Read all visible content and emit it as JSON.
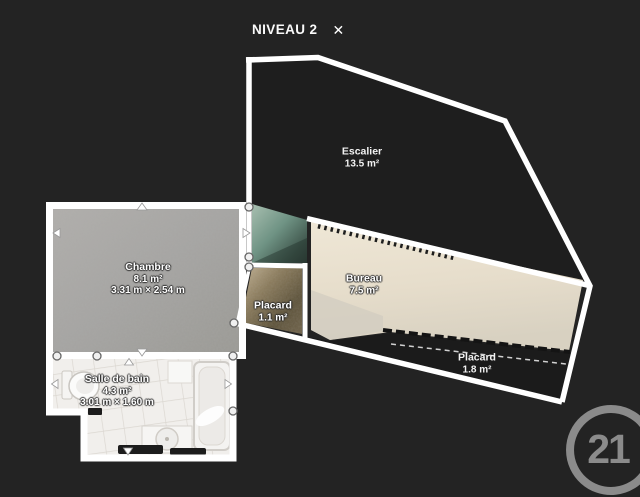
{
  "header": {
    "title": "NIVEAU 2",
    "close_label": "✕"
  },
  "rooms": [
    {
      "key": "escalier",
      "name": "Escalier",
      "area": "13.5 m²"
    },
    {
      "key": "chambre",
      "name": "Chambre",
      "area": "8.1 m²",
      "dims": "3.31 m × 2.54 m"
    },
    {
      "key": "placard-centre",
      "name": "Placard",
      "area": "1.1 m²"
    },
    {
      "key": "bureau",
      "name": "Bureau",
      "area": "7.5 m²"
    },
    {
      "key": "placard-droit",
      "name": "Placard",
      "area": "1.8 m²"
    },
    {
      "key": "salle-de-bain",
      "name": "Salle de bain",
      "area": "4.3 m²",
      "dims": "3.01 m × 1.60 m"
    }
  ],
  "branding": {
    "logo_number": "21"
  },
  "colors": {
    "background": "#232323",
    "plan_interior": "#1e1e1e",
    "wall": "#ffffff",
    "logo": "#8b8b8b"
  }
}
